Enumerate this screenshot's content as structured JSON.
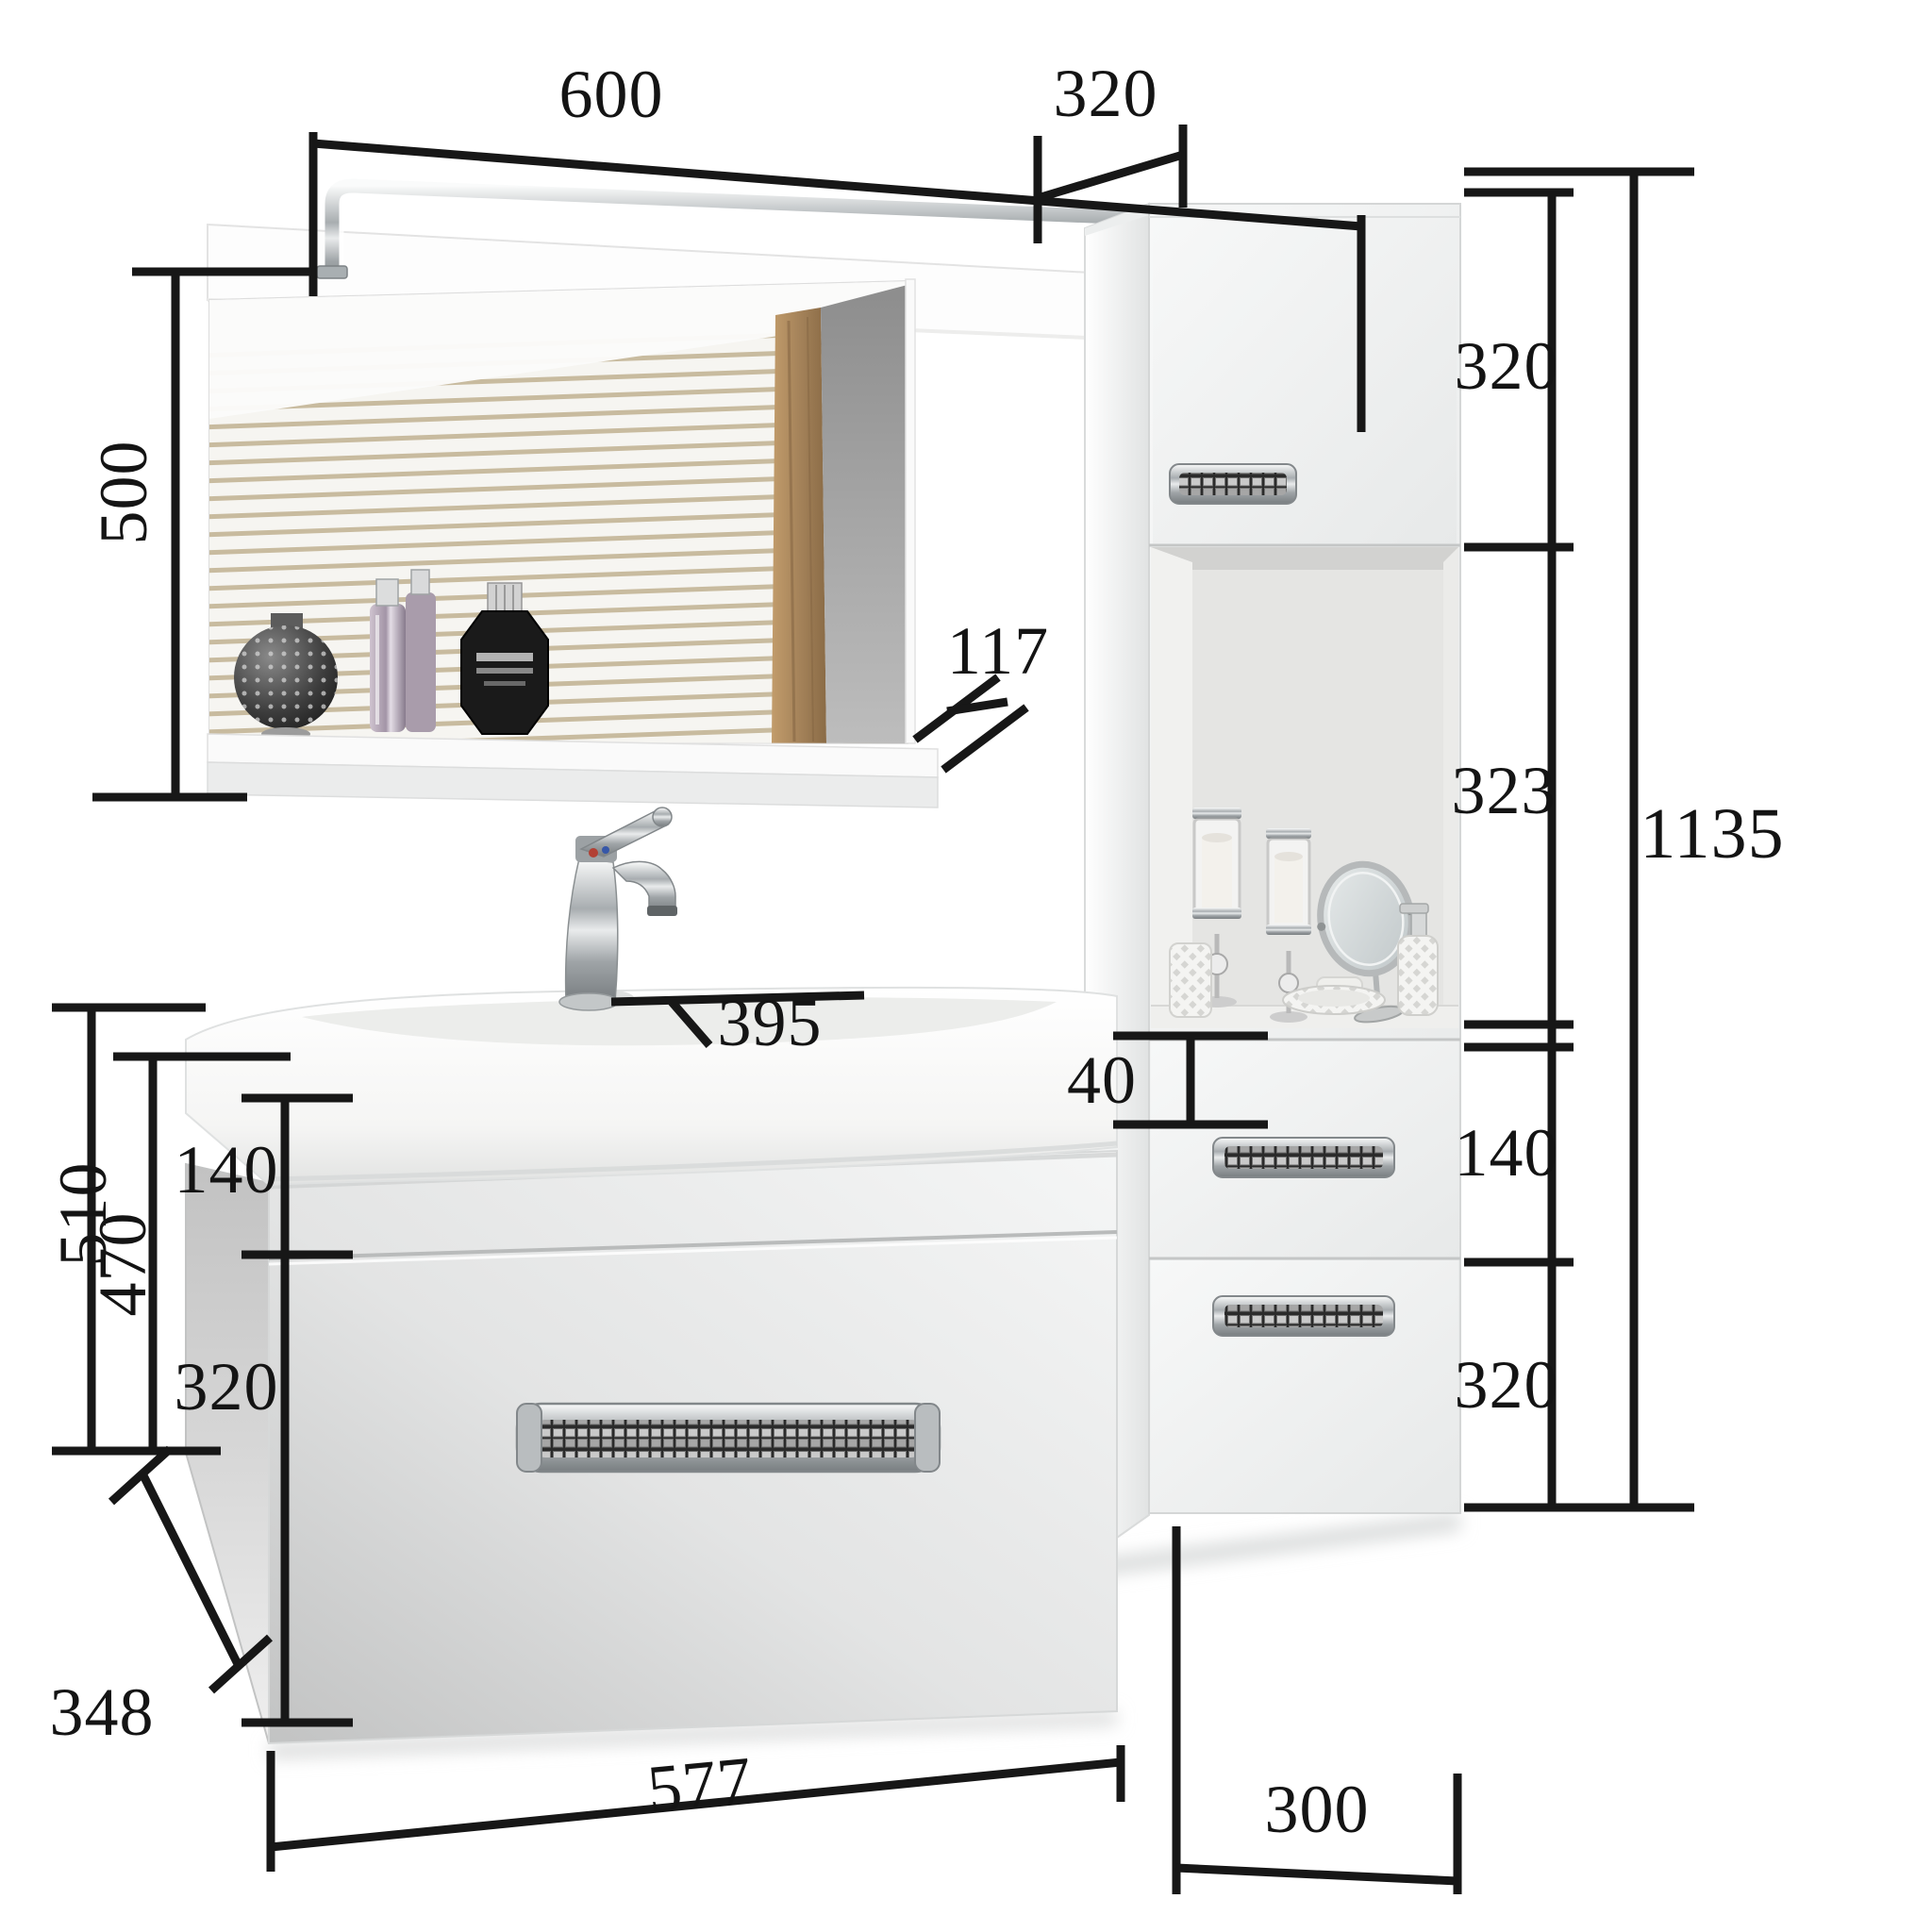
{
  "page": {
    "background": "#ffffff"
  },
  "colors": {
    "dimension_line": "#171717",
    "label_text": "#141414",
    "wood_accent": "#a5835a",
    "wall_gray": "#9a9a9a",
    "chrome": "#c6c9cb",
    "furniture_white": "#f2f3f3"
  },
  "labels": {
    "mirror_width": "600",
    "mirror_height": "500",
    "shelf_depth": "117",
    "cabinet_depth": "320",
    "cabinet_top_door_height": "320",
    "cabinet_niche_height": "323",
    "cabinet_drawer_height": "140",
    "cabinet_bottom_door_height": "320",
    "cabinet_total_height": "1135",
    "cabinet_width": "300",
    "sink_depth": "395",
    "sink_basin_height": "40",
    "vanity_top_section_height": "140",
    "vanity_total_height": "510",
    "vanity_body_height": "470",
    "vanity_drawer_height": "320",
    "vanity_depth": "348",
    "vanity_width": "577"
  }
}
